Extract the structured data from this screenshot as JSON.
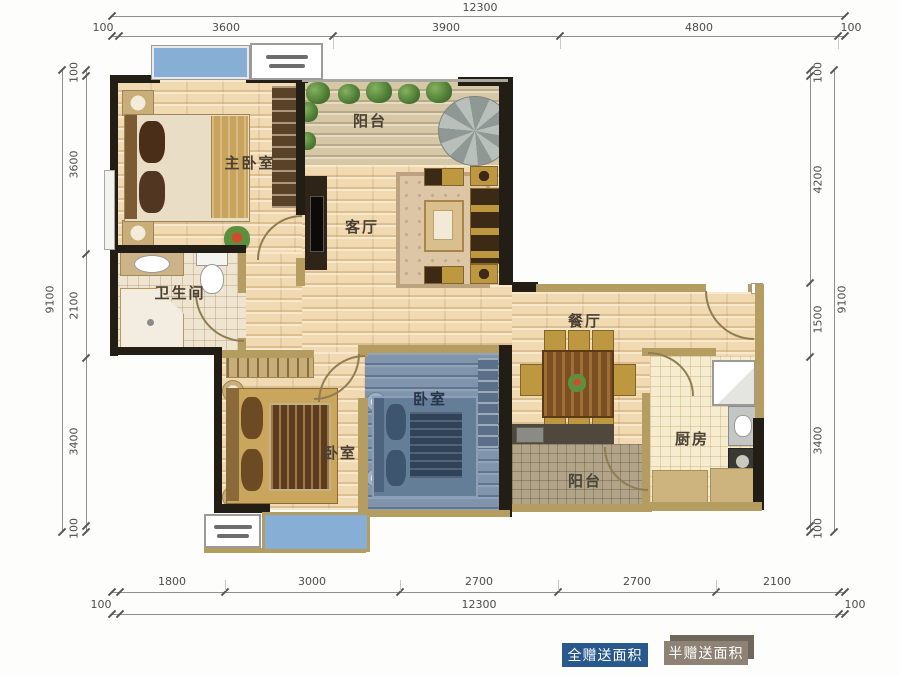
{
  "plan": {
    "type": "apartment-floor-plan",
    "rooms": {
      "master_bedroom": "主卧室",
      "balcony_top": "阳台",
      "living_room": "客厅",
      "bathroom": "卫生间",
      "dining_room": "餐厅",
      "bedroom_blue": "卧室",
      "bedroom_left": "卧室",
      "kitchen": "厨房",
      "balcony_bottom": "阳台"
    }
  },
  "dimensions": {
    "top": {
      "overall": "12300",
      "segments": [
        "100",
        "3600",
        "3900",
        "4800",
        "100"
      ]
    },
    "bottom": {
      "overall": "12300",
      "segments": [
        "1800",
        "3000",
        "2700",
        "2700",
        "2100"
      ],
      "pads": [
        "100",
        "100"
      ]
    },
    "left": {
      "overall": "9100",
      "segments": [
        "100",
        "3600",
        "2100",
        "3400",
        "100"
      ]
    },
    "right": {
      "overall": "9100",
      "segments": [
        "100",
        "4200",
        "1500",
        "3400",
        "100"
      ]
    }
  },
  "legend": {
    "items": [
      {
        "label": "全赠送面积",
        "color": "#29588c"
      },
      {
        "label": "半赠送面积",
        "color": "#8d8274"
      }
    ]
  },
  "colors": {
    "wall": "#221d15",
    "light_wall": "#b59c60",
    "wood_floor": "#f1d9b2",
    "gifted_blue_tint": "#8095ab",
    "window_blue": "#87aed4",
    "legend_full_gift": "#29588c",
    "legend_half_gift": "#8d8274"
  }
}
